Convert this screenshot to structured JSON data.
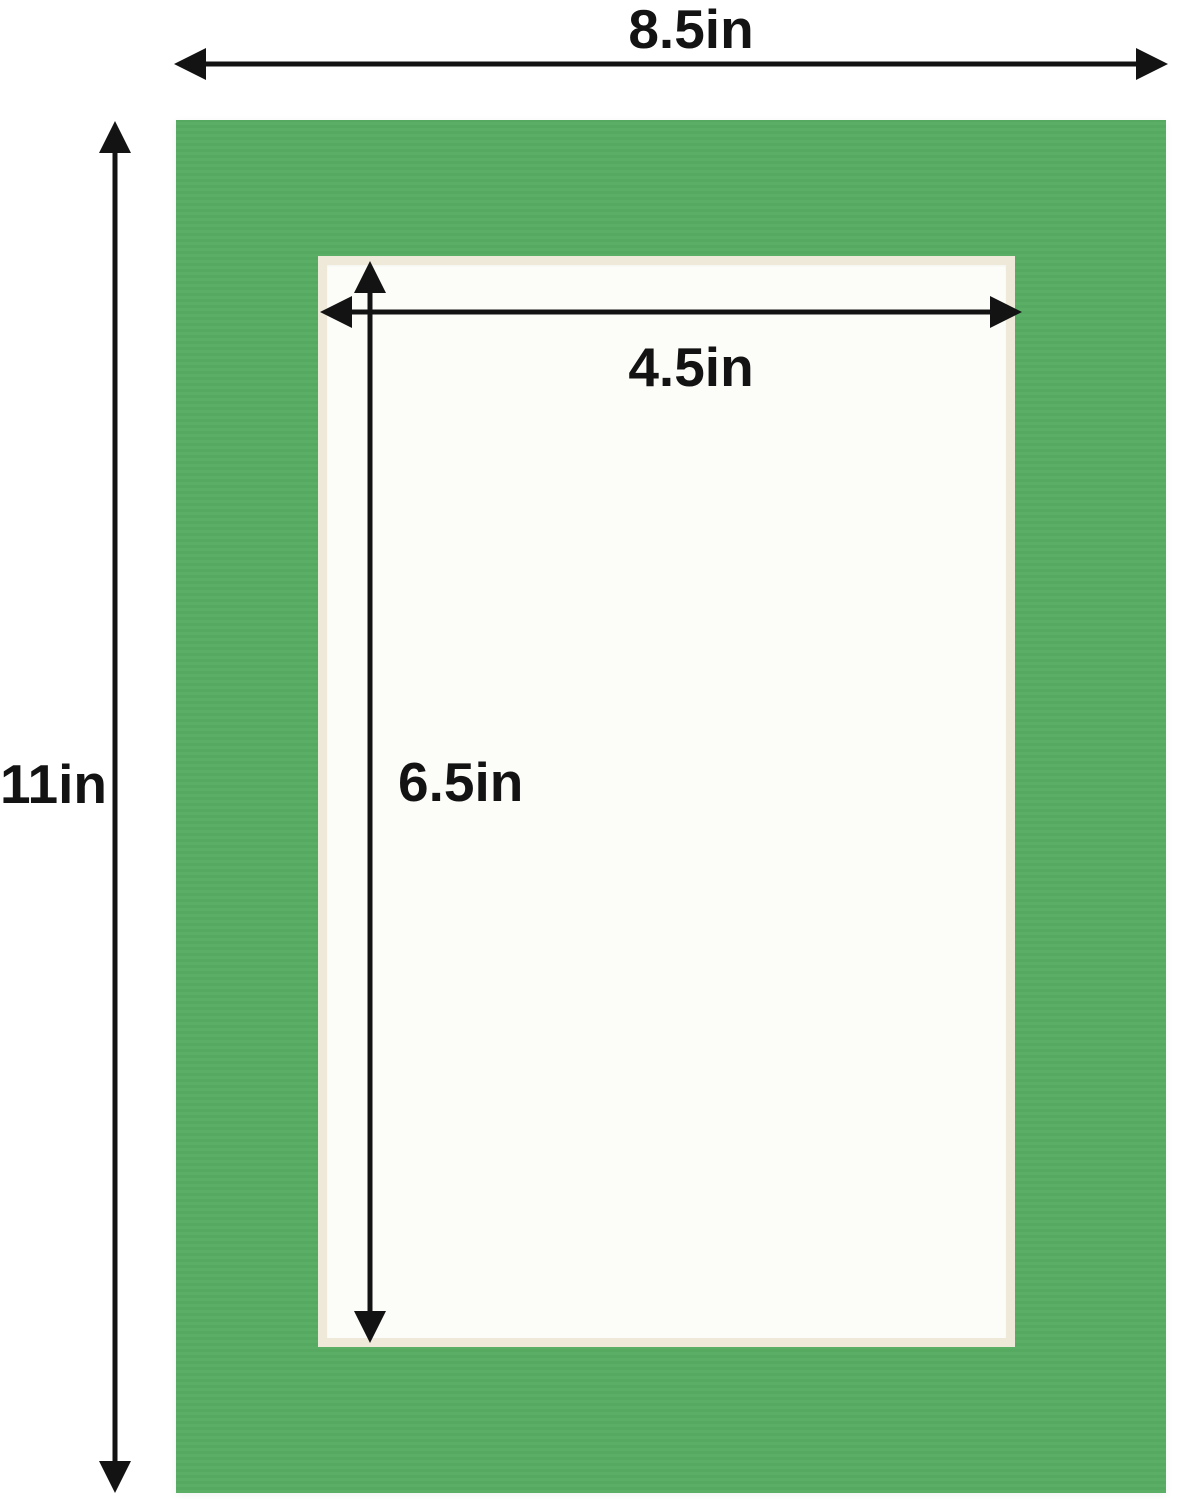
{
  "diagram": {
    "title": "mat board dimension diagram",
    "outer_width_label": "8.5in",
    "outer_height_label": "11in",
    "opening_width_label": "4.5in",
    "opening_height_label": "6.5in"
  },
  "colors": {
    "mat_green": "#57ac62",
    "bevel_cream": "#efe9da",
    "opening_white": "#fcfcf9",
    "arrow_black": "#131313",
    "background": "#ffffff"
  }
}
